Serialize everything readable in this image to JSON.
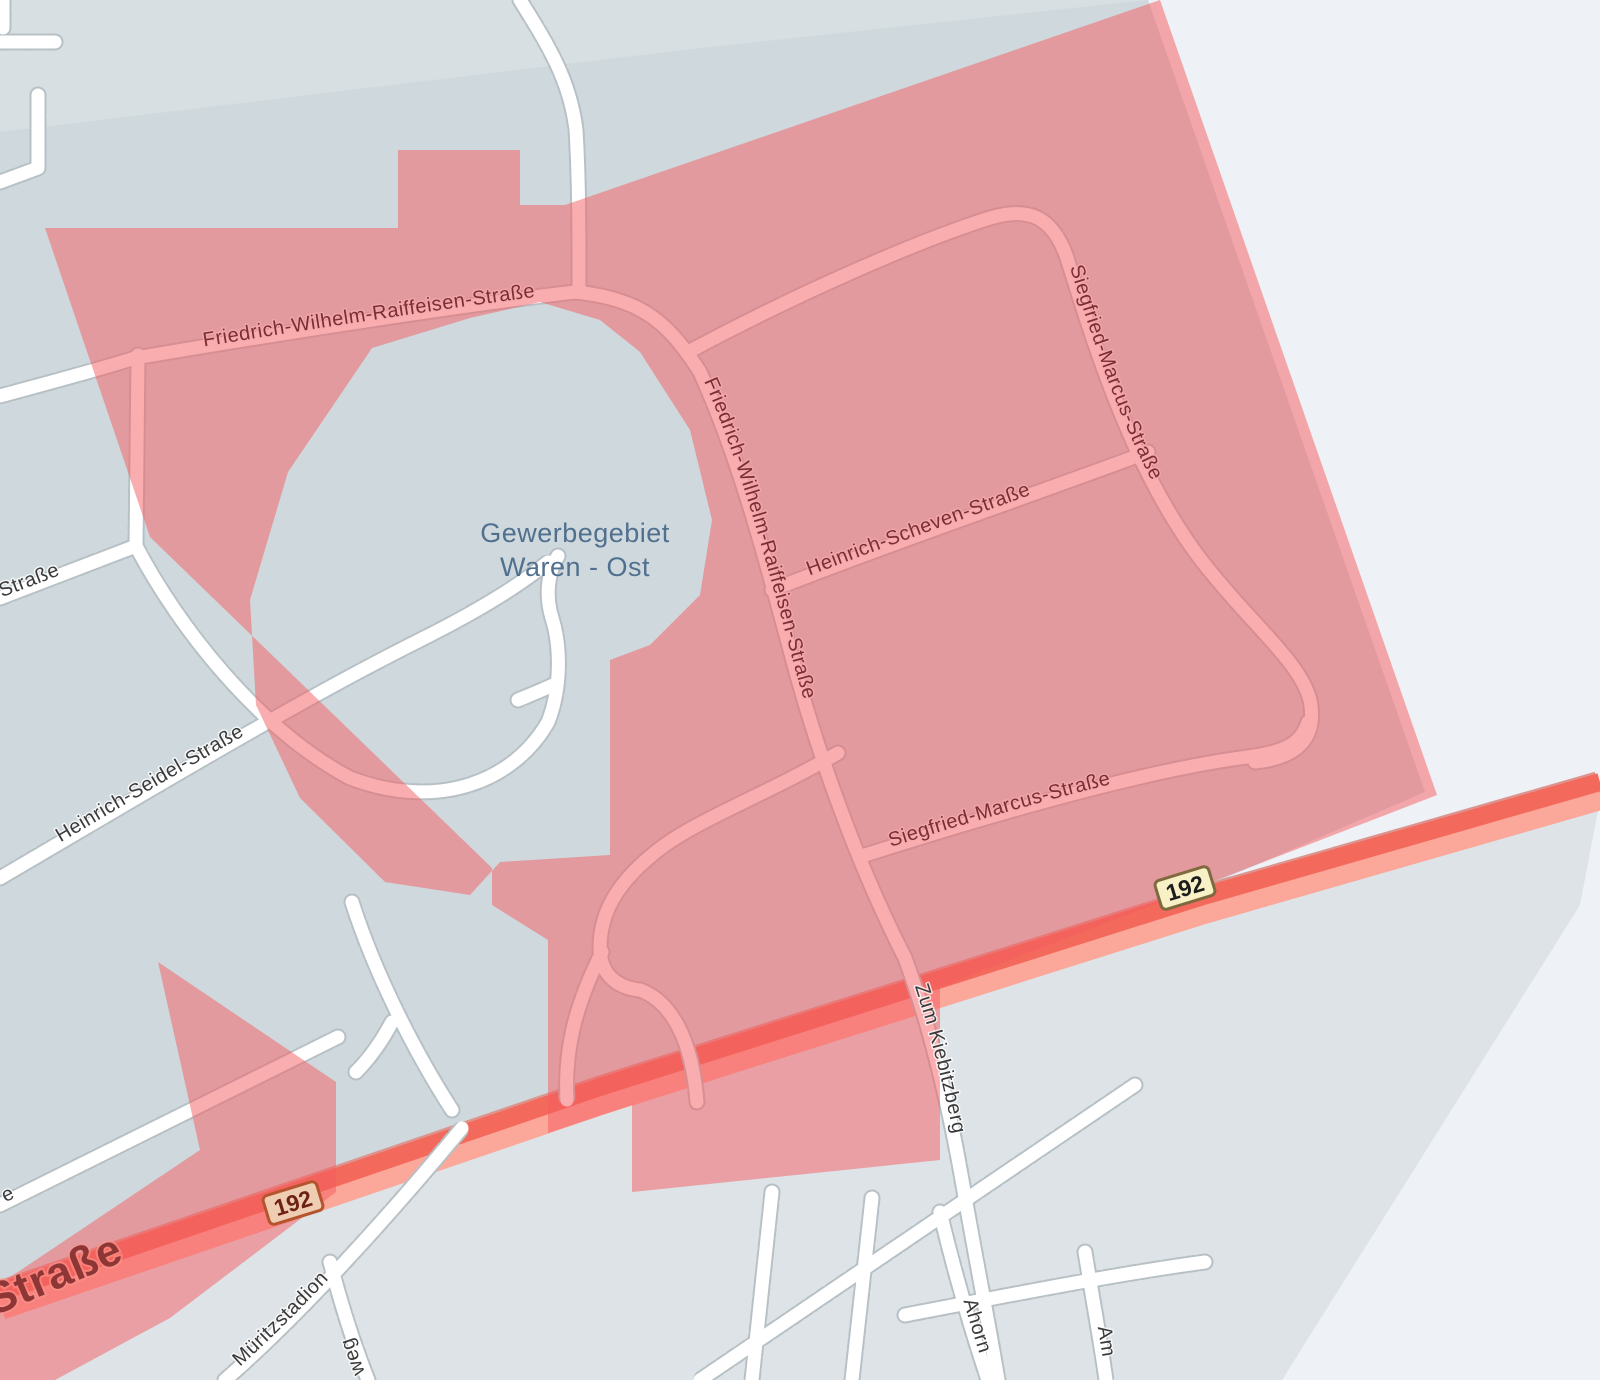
{
  "map": {
    "area_label": {
      "line1": "Gewerbegebiet",
      "line2": "Waren - Ost"
    },
    "streets": {
      "raiffeisen": "Friedrich-Wilhelm-Raiffeisen-Straße",
      "raiffeisen_south": "Friedrich-Wilhelm-Raiffeisen-Straße",
      "scheven": "Heinrich-Scheven-Straße",
      "marcus_east": "Siegfried-Marcus-Straße",
      "marcus_south": "Siegfried-Marcus-Straße",
      "seidel": "Heinrich-Seidel-Straße",
      "kiebitzberg": "Zum Kiebitzberg",
      "strasse_left_fragment": "Straße",
      "strasse_main": "Straße",
      "e_fragment": "e",
      "mueritzstadion": "Müritzstadion",
      "weg_fragment": "weg",
      "ahorn_fragment": "Ahorn",
      "am_fragment": "Am"
    },
    "route_badges": {
      "left": "192",
      "right": "192"
    },
    "colors": {
      "background": "#eef1f5",
      "land_gray_upper": "#cfd8dc",
      "land_gray_lower": "#dde3e7",
      "overlay_red": "rgba(246,91,96,0.5)",
      "road_white": "#ffffff",
      "highway_core": "#f3695c",
      "highway_fill": "#fba79a",
      "label_in_zone": "#7c2d33",
      "label_out_zone": "#3a3a3a",
      "area_label_color": "#50708f",
      "badge_fill": "#f8f0c6"
    }
  }
}
